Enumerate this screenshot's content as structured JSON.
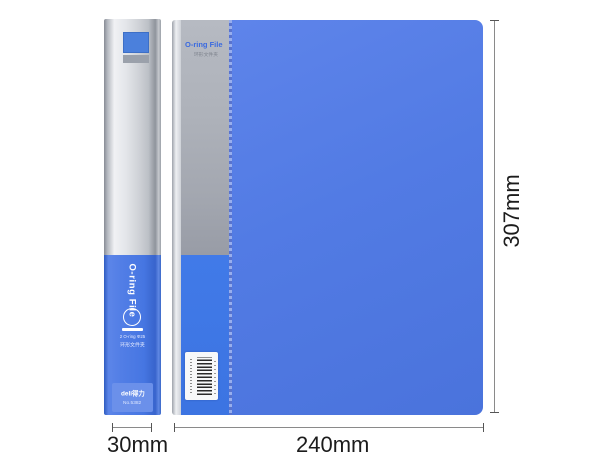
{
  "spine": {
    "vertical_label": "O-ring File",
    "spec_line1": "2 O-ring Φ25",
    "spec_line2": "环形文件夹",
    "brand_logo": "deli得力",
    "model_no": "No.5382"
  },
  "cover": {
    "title": "O-ring File",
    "subtitle": "环形文件夹"
  },
  "dimensions": {
    "spine_width_label": "30mm",
    "cover_width_label": "240mm",
    "cover_height_label": "307mm"
  },
  "colors": {
    "cover_blue": "#4d78e0",
    "band_silver": "#aeb2ba",
    "band_blue": "#3f79e6",
    "title_blue": "#3a6ae0",
    "dimension_line": "#8a8a8a",
    "dimension_text": "#1c1c1c",
    "background": "#ffffff"
  }
}
